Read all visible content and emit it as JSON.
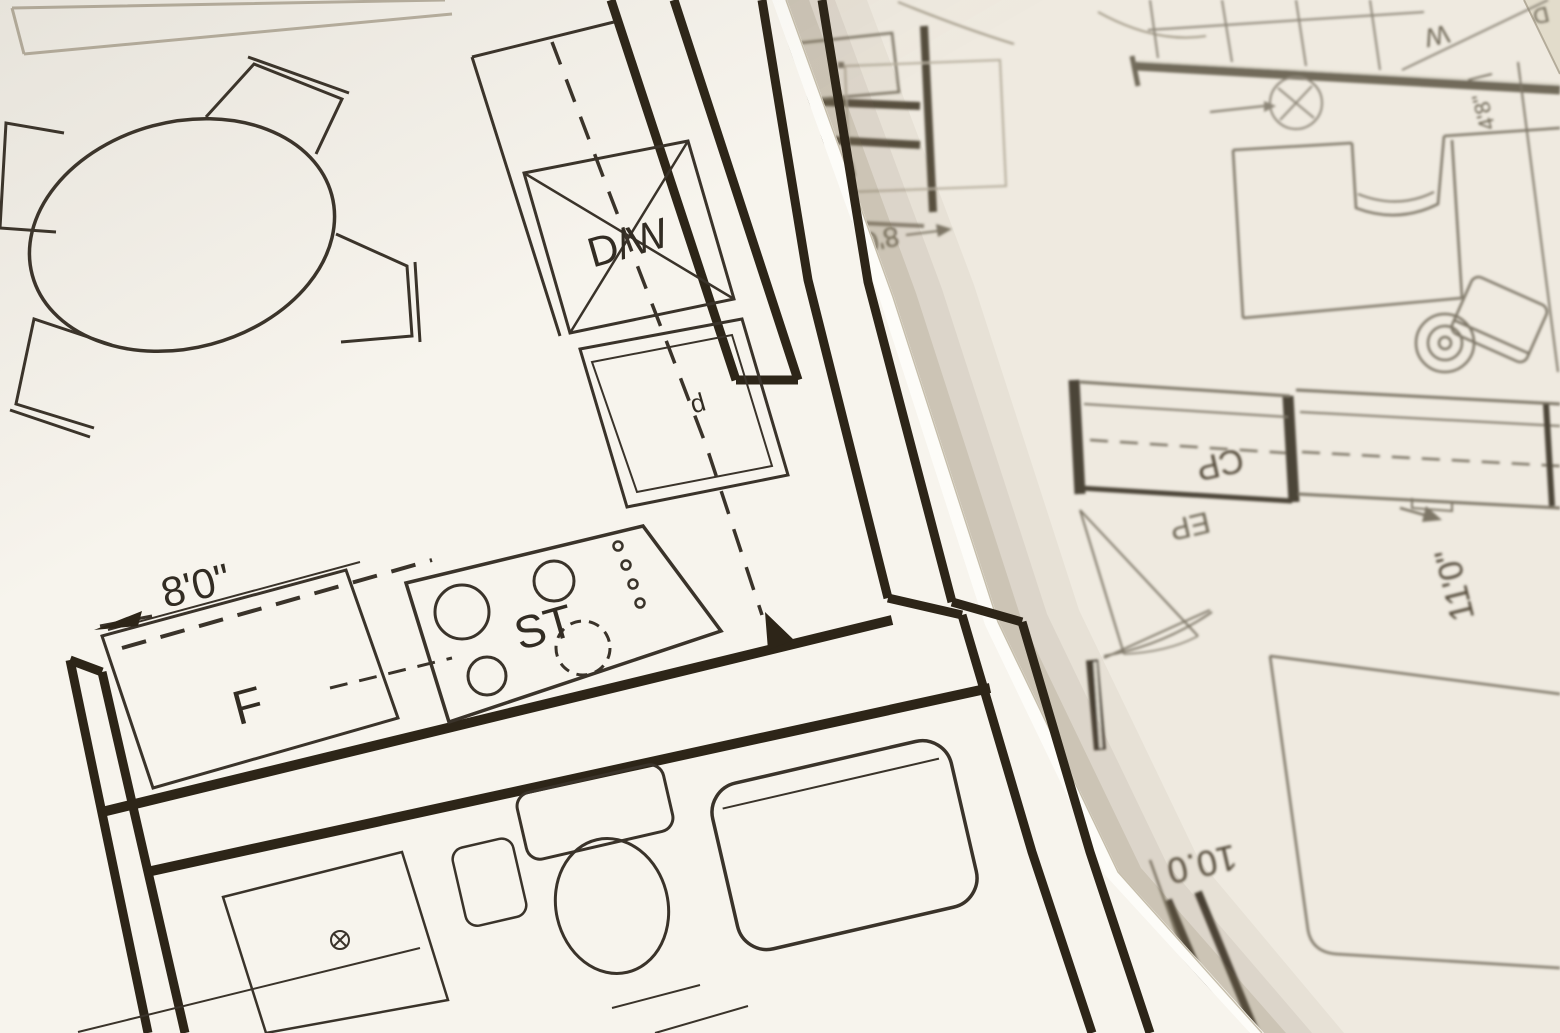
{
  "colors": {
    "paper_foreground": "#f7f4ed",
    "paper_background": "#efeae0",
    "ink_dark": "#2d2518",
    "ink_thin": "#3a332a",
    "ink_faded": "#847c6c",
    "edge_shadow": "#8a7c60"
  },
  "labels": {
    "fg": {
      "dishwasher": "D/W",
      "stove": "ST",
      "fridge": "F",
      "kitchen_dim": "8'0\"",
      "sink_mark": "d"
    },
    "bg": {
      "washer": "W",
      "dryer": "D",
      "fridge": "F",
      "dim_small": "8'0\"",
      "closet": "CP",
      "entry": "EP",
      "bedroom_dim": "11'0\"",
      "closet_dim": "4'8\"",
      "room_dim": "10.0"
    }
  }
}
